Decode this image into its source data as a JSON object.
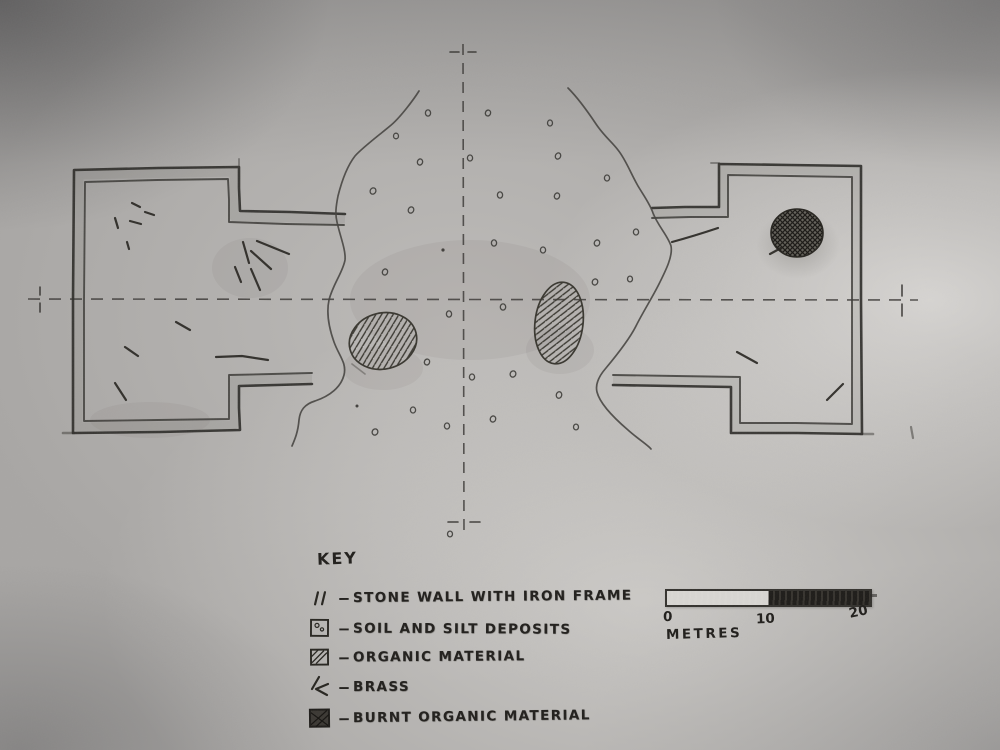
{
  "colors": {
    "pencil": "#2e2c29",
    "pencil_soft": "#4a4845",
    "paper": "#aeacaa",
    "paper_light": "#d9d7d4",
    "fill_dark": "#24221f"
  },
  "key": {
    "heading": "KEY",
    "dash": "–",
    "items": [
      {
        "id": "stone-wall",
        "label": "STONE WALL WITH IRON FRAME"
      },
      {
        "id": "soil-silt",
        "label": "SOIL AND SILT DEPOSITS"
      },
      {
        "id": "organic",
        "label": "ORGANIC MATERIAL"
      },
      {
        "id": "brass",
        "label": "BRASS"
      },
      {
        "id": "burnt-organic",
        "label": "BURNT ORGANIC MATERIAL"
      }
    ]
  },
  "scale_bar": {
    "tick_labels": [
      "0",
      "10",
      "20"
    ],
    "unit_label": "METRES"
  }
}
